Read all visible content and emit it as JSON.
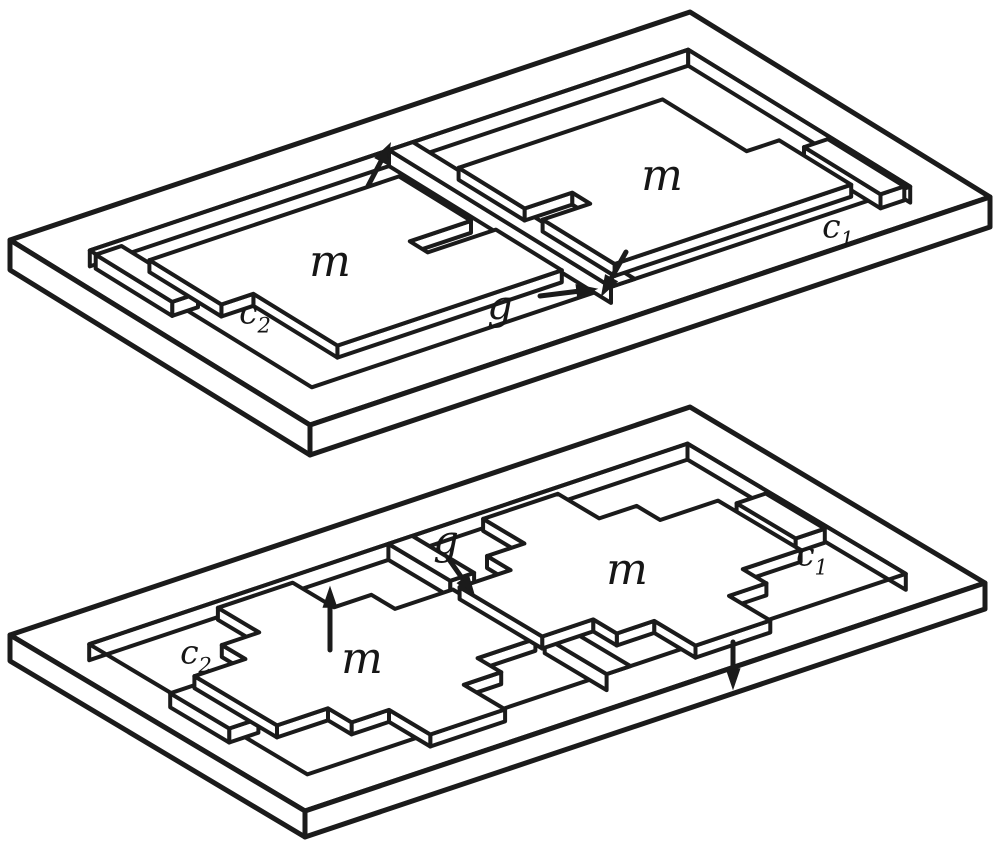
{
  "figure": {
    "background": "#ffffff",
    "ink": "#1b1b1b",
    "devices": [
      {
        "id": "top-plate",
        "labels": {
          "mass_left": "m",
          "mass_right": "m",
          "cap_left": {
            "base": "c",
            "sub": "2"
          },
          "cap_right": {
            "base": "c",
            "sub": "1"
          },
          "gap": "g"
        }
      },
      {
        "id": "bottom-plate",
        "labels": {
          "mass_left": "m",
          "mass_right": "m",
          "cap_left": {
            "base": "c",
            "sub": "2"
          },
          "cap_right": {
            "base": "c",
            "sub": "1"
          },
          "gap": "g"
        }
      }
    ]
  }
}
